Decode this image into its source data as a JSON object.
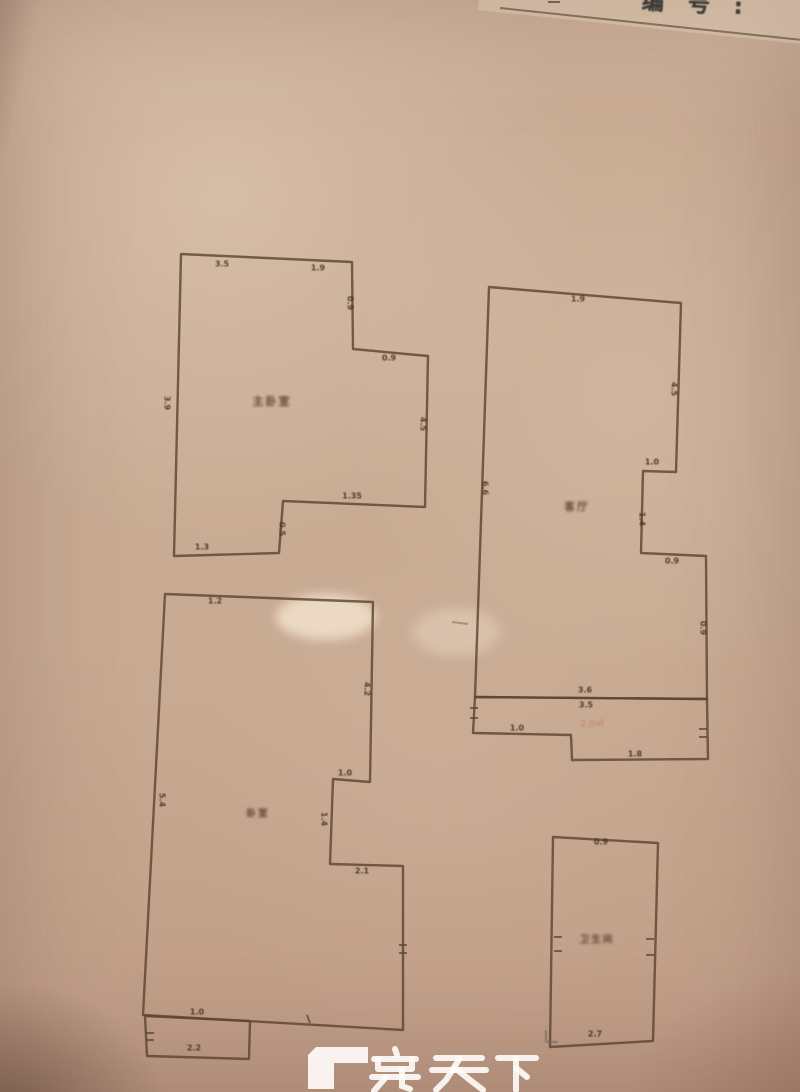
{
  "photo": {
    "header": {
      "doc_no_label": "编号:"
    },
    "watermark": {
      "brand": "房天下",
      "logo": "fang-gamma-logo"
    },
    "stamp": "2.0㎡"
  },
  "plan": {
    "room_labels": {
      "top_left": "主卧室",
      "top_right": "客厅",
      "bottom_left": "卧室",
      "bottom_right": "卫生间"
    },
    "dim_labels": {
      "a1": "3.5",
      "a2": "1.9",
      "a3": "0.9",
      "a4": "0.9",
      "a5": "4.5",
      "a6": "3.9",
      "a7": "1.35",
      "a8": "0.5",
      "a9": "1.3",
      "b1": "1.9",
      "b2": "4.5",
      "b3": "1.0",
      "b4": "1.4",
      "b5": "0.9",
      "b6": "6.6",
      "b7": "3.6",
      "b8": "3.5",
      "b9": "1.0",
      "b10": "1.8",
      "b11": "0.9",
      "c1": "1.2",
      "c2": "4.2",
      "c3": "1.0",
      "c4": "1.4",
      "c5": "2.1",
      "c6": "5.4",
      "c7": "1.0",
      "c8": "2.2",
      "d1": "0.9",
      "d2": "2.7"
    },
    "colors": {
      "wall": "#5d4531",
      "paper": "#c9ab93",
      "label": "#3e2d1c",
      "watermark": "#fdfbf7"
    }
  }
}
